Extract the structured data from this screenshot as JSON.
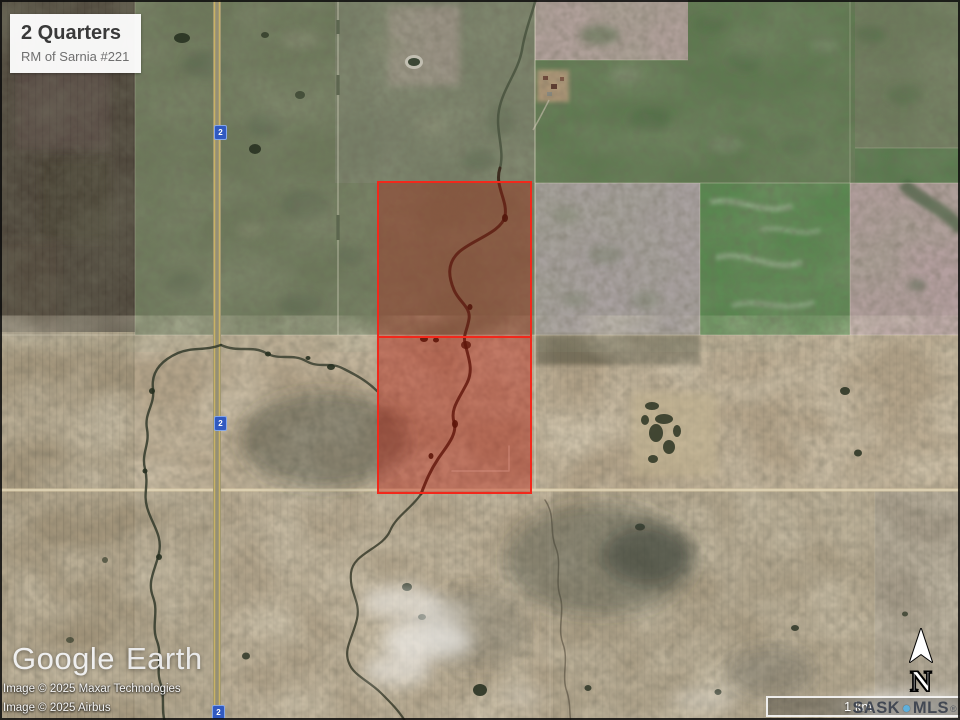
{
  "overlay_label": {
    "title": "2 Quarters",
    "subtitle": "RM of Sarnia #221"
  },
  "parcel": {
    "name": "2 Quarters",
    "quarter_count": 2,
    "outline_color": "#f2281b",
    "fill_top": "rgba(182,28,16,0.33)",
    "fill_bottom": "rgba(182,22,10,0.40)"
  },
  "highway": {
    "shield_label": "2",
    "shield_color": "#3059c0"
  },
  "branding": {
    "logo_part1": "Google",
    "logo_part2": "Earth"
  },
  "credits": {
    "line1": "Image © 2025 Maxar Technologies",
    "line2": "Image © 2025 Airbus"
  },
  "compass": {
    "north_label": "N"
  },
  "scale_bar": {
    "label": "1 km"
  },
  "watermark": {
    "part1": "SASK",
    "part2": "MLS",
    "registered": "®",
    "dot_color": "#5fb0dc"
  }
}
